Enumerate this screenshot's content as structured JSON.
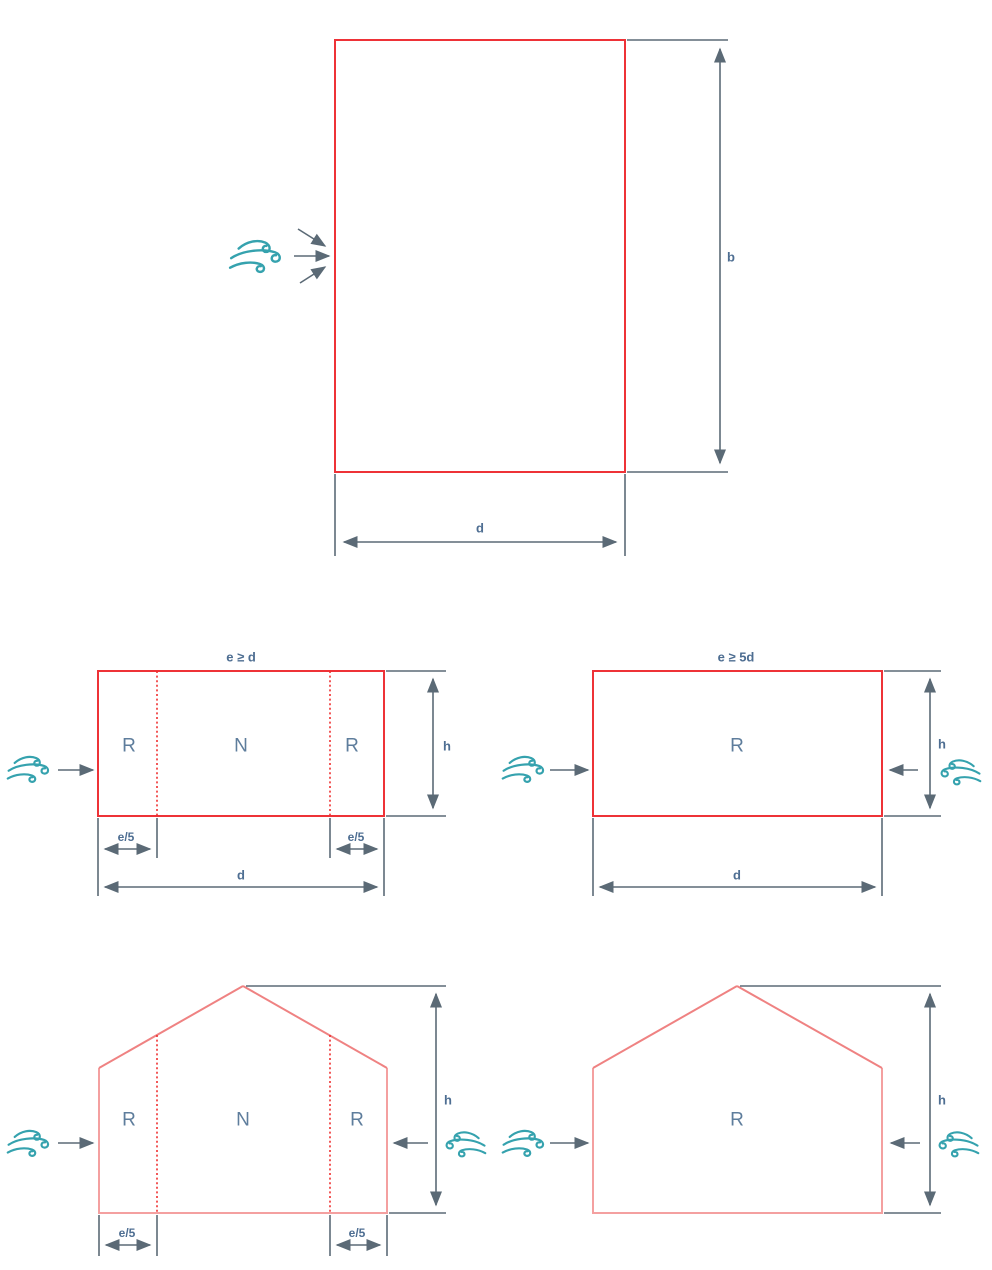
{
  "colors": {
    "outline_red": "#ee3237",
    "wall_salmon": "#f4a0a0",
    "roof_salmon": "#ef8282",
    "dotted_red": "#ee2f2f",
    "dimension_gray": "#5b6a76",
    "label_blue": "#4e6e92",
    "zone_label_blue": "#5e7d9c",
    "wind_teal": "#35a2ae"
  },
  "plan_view": {
    "height_label": "b",
    "width_label": "d"
  },
  "elevation_e_ge_d": {
    "title": "e ≥ d",
    "zone_left": "R",
    "zone_mid": "N",
    "zone_right": "R",
    "height_label": "h",
    "width_label": "d",
    "edge_left_label": "e/5",
    "edge_right_label": "e/5"
  },
  "elevation_e_ge_5d": {
    "title": "e ≥ 5d",
    "zone": "R",
    "height_label": "h",
    "width_label": "d"
  },
  "gable_zoned": {
    "zone_left": "R",
    "zone_mid": "N",
    "zone_right": "R",
    "height_label": "h",
    "edge_left_label": "e/5",
    "edge_right_label": "e/5"
  },
  "gable_single": {
    "zone": "R",
    "height_label": "h"
  }
}
